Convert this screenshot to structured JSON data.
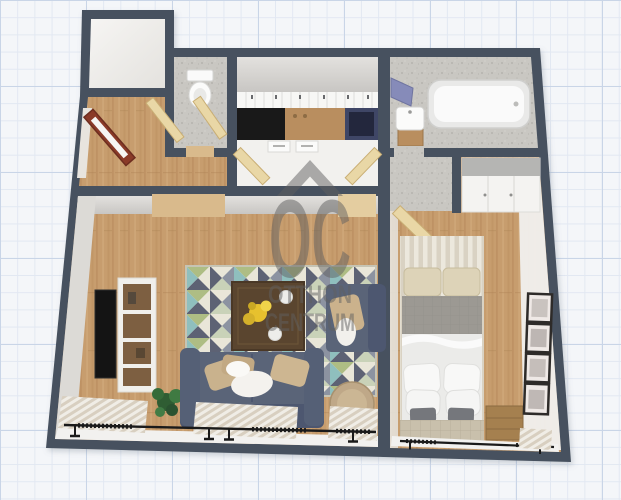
{
  "watermark": {
    "icon": "roof-chevron-icon",
    "brand_initials": "OC",
    "brand_line1": "OTTHON",
    "brand_line2": "CENTRUM"
  },
  "palette": {
    "canvas": "#f4f6f9",
    "grid_minor": "#e2e8f2",
    "grid_major": "#c9d5e7",
    "wall": "#47515e",
    "floor_wood": "#c79d6e",
    "floor_wood_streak": "#b5895a",
    "tile_gray": "#c9c7c2",
    "kitchen_floor": "#f2f1ee",
    "counter_black": "#191919",
    "counter_navy": "#3f4666",
    "counter_wood": "#b98e5f",
    "door_red": "#8a3a28",
    "door_light": "#e9d7a6",
    "sofa": "#5a6478",
    "sofa_dark": "#4d5770",
    "pillow_beige": "#cbb28d",
    "rug_cream": "#e9e6d8",
    "rug_olive": "#aebd84",
    "rug_teal": "#8fbfbe",
    "rug_slate": "#5d6274",
    "table_wood": "#5a452f",
    "flowers_yellow": "#e7c12e",
    "tv_black": "#141414",
    "plant_green": "#3a6b39",
    "pouf": "#bfa888",
    "curtain_light": "#f0ede6",
    "curtain_dark": "#d8cfc0",
    "bed_headboard": "#ddd3b8",
    "bed_gray": "#9c9993",
    "bed_white": "#ebebe9",
    "bed_bench": "#c9c0ac",
    "mirror_purple": "#868bb9",
    "watermark_gray": "#5f5f5f"
  },
  "scene": {
    "type": "3d-floor-plan-top-view",
    "rooms": [
      {
        "name": "storage-room",
        "furniture": []
      },
      {
        "name": "wc",
        "furniture": [
          "toilet"
        ]
      },
      {
        "name": "entry-hall",
        "furniture": [
          "red-front-door",
          "interior-doors"
        ]
      },
      {
        "name": "kitchen",
        "furniture": [
          "upper-cabinets",
          "black-counter",
          "wood-counter",
          "navy-cooktop-cabinet",
          "base-drawers",
          "open-doors"
        ]
      },
      {
        "name": "bathroom",
        "furniture": [
          "bathtub",
          "sink-with-cabinet",
          "purple-mirror"
        ]
      },
      {
        "name": "vestibule",
        "furniture": [
          "open-door"
        ]
      },
      {
        "name": "living-room",
        "furniture": [
          "tv",
          "tv-stand",
          "plant",
          "geometric-rug",
          "coffee-table-with-flowers",
          "sofa",
          "armchair",
          "pouf",
          "curtains",
          "curtain-rod"
        ]
      },
      {
        "name": "bedroom",
        "furniture": [
          "double-bed",
          "striped-rug",
          "wardrobe",
          "nightstand",
          "wall-frames",
          "curtain-rod"
        ]
      }
    ]
  }
}
